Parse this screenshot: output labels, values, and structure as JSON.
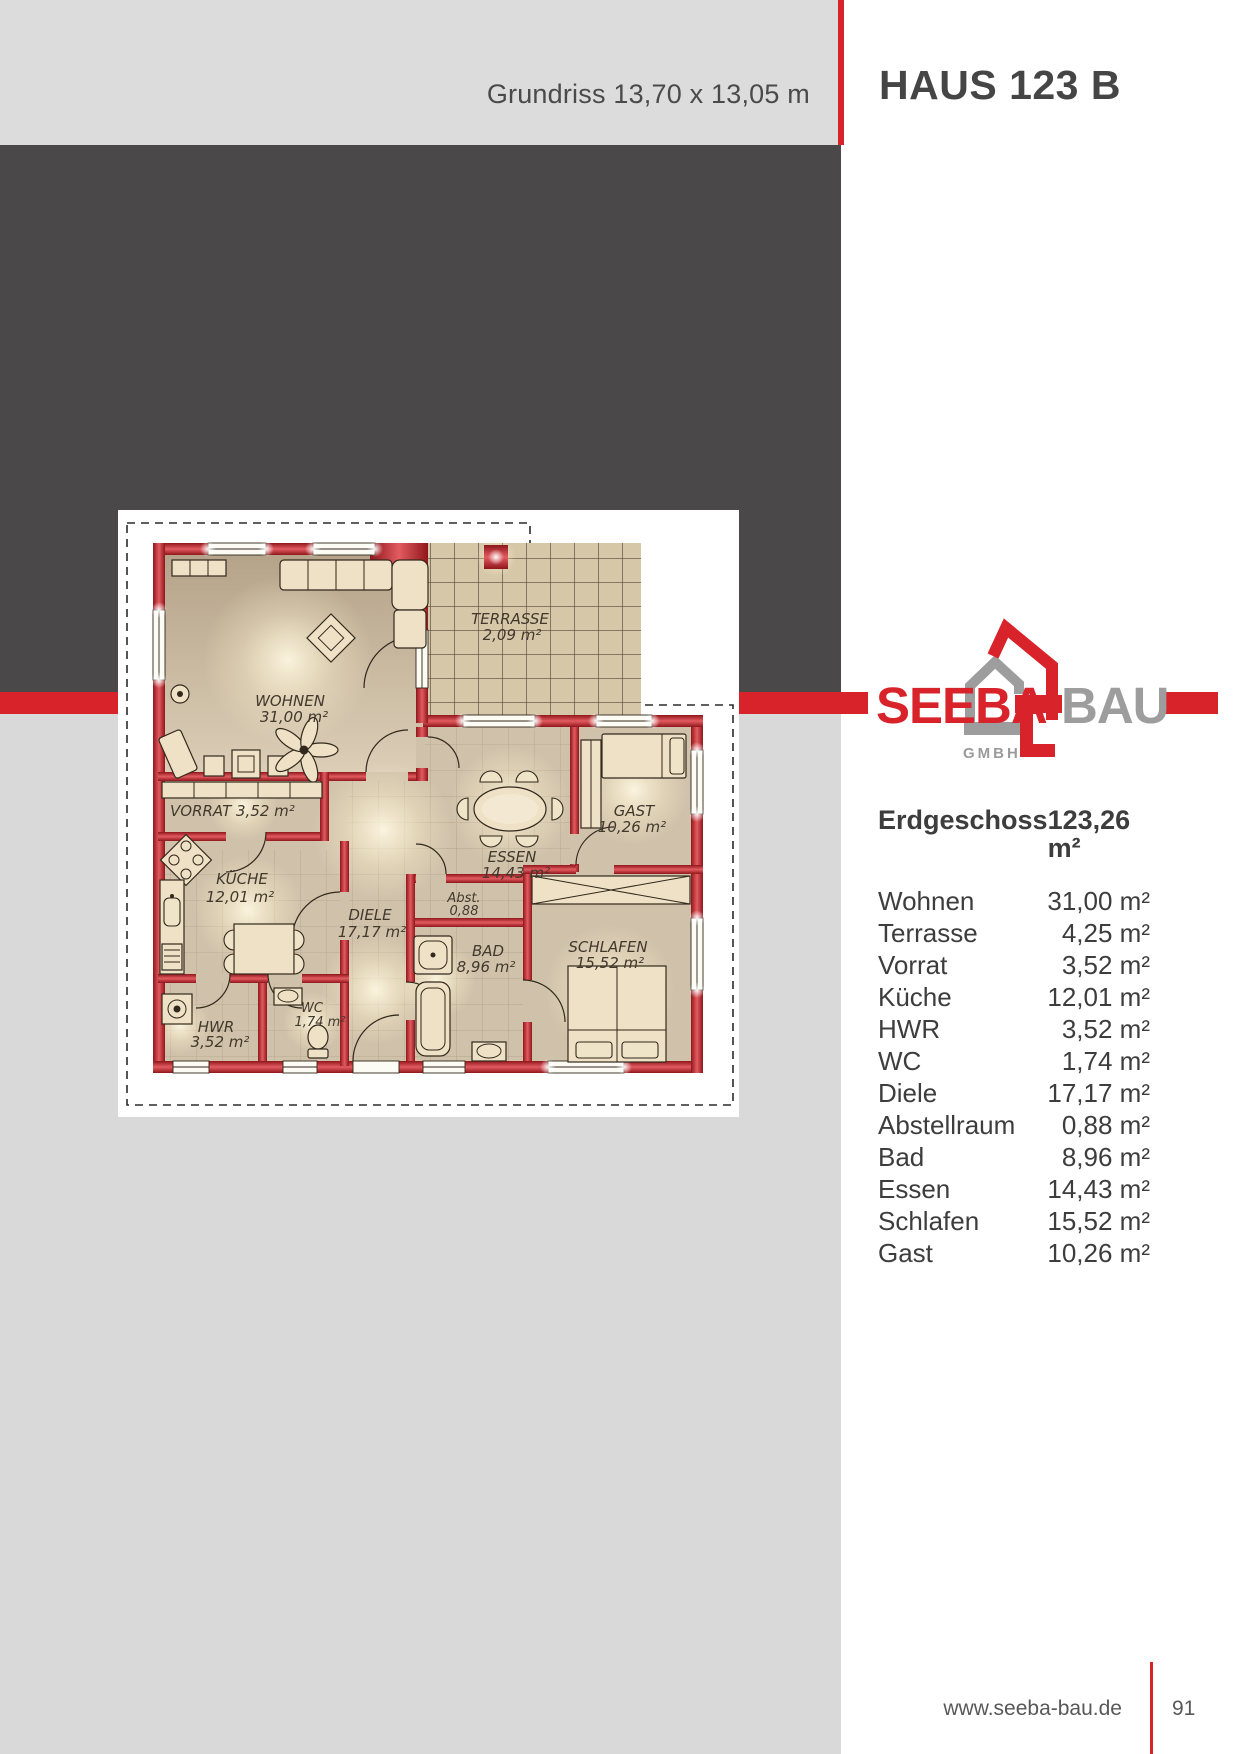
{
  "header": {
    "plan_dimensions": "Grundriss 13,70 x 13,05 m",
    "title": "HAUS 123 B"
  },
  "logo": {
    "word1": "SEEBA",
    "word2": "BAU",
    "subtitle": "GMBH"
  },
  "area_table": {
    "heading": {
      "label": "Erdgeschoss",
      "value": "123,26 m²"
    },
    "rows": [
      {
        "label": "Wohnen",
        "value": "31,00 m²"
      },
      {
        "label": "Terrasse",
        "value": "4,25 m²"
      },
      {
        "label": "Vorrat",
        "value": "3,52 m²"
      },
      {
        "label": "Küche",
        "value": "12,01 m²"
      },
      {
        "label": "HWR",
        "value": "3,52 m²"
      },
      {
        "label": "WC",
        "value": "1,74 m²"
      },
      {
        "label": "Diele",
        "value": "17,17 m²"
      },
      {
        "label": "Abstellraum",
        "value": "0,88 m²"
      },
      {
        "label": "Bad",
        "value": "8,96 m²"
      },
      {
        "label": "Essen",
        "value": "14,43 m²"
      },
      {
        "label": "Schlafen",
        "value": "15,52 m²"
      },
      {
        "label": "Gast",
        "value": "10,26 m²"
      }
    ]
  },
  "floorplan": {
    "labels": {
      "wohnen": {
        "name": "WOHNEN",
        "area": "31,00 m²"
      },
      "terrasse": {
        "name": "TERRASSE",
        "area": "2,09 m²"
      },
      "vorrat": {
        "name": "VORRAT 3,52 m²"
      },
      "kueche": {
        "name": "KÜCHE",
        "area": "12,01 m²"
      },
      "diele": {
        "name": "DIELE",
        "area": "17,17 m²"
      },
      "abstellraum": {
        "name": "Abst.",
        "area": "0,88"
      },
      "essen": {
        "name": "ESSEN",
        "area": "14,43 m²"
      },
      "bad": {
        "name": "BAD",
        "area": "8,96 m²"
      },
      "gast": {
        "name": "GAST",
        "area": "10,26 m²"
      },
      "schlafen": {
        "name": "SCHLAFEN",
        "area": "15,52 m²"
      },
      "wc": {
        "name": "WC",
        "area": "1,74 m²"
      },
      "hwr": {
        "name": "HWR",
        "area": "3,52 m²"
      }
    }
  },
  "footer": {
    "website": "www.seeba-bau.de",
    "page_number": "91"
  },
  "colors": {
    "brand_red": "#d9232b",
    "dark_gray": "#4b484a",
    "header_gray": "#dcdcdc",
    "light_gray": "#d9d9d9",
    "logo_gray": "#9d9d9d",
    "text_dark": "#3d3d3d"
  }
}
